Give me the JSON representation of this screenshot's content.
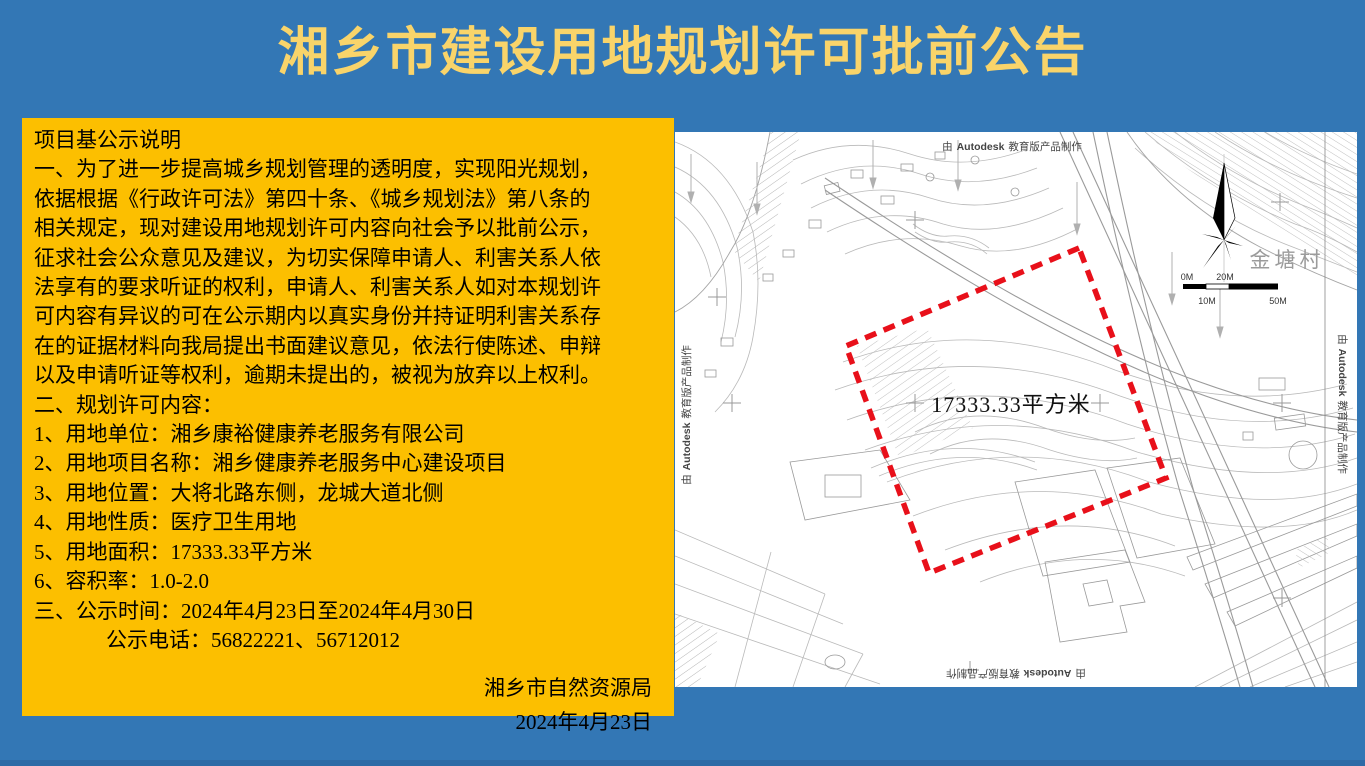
{
  "title": "湘乡市建设用地规划许可批前公告",
  "colors": {
    "background_blue": "#3377b5",
    "panel_gold": "#fcbf00",
    "title_yellow": "#f9d46a",
    "boundary_red": "#e8101a"
  },
  "notice": {
    "lines": [
      "项目基公示说明",
      "一、为了进一步提高城乡规划管理的透明度，实现阳光规划，",
      "依据根据《行政许可法》第四十条、《城乡规划法》第八条的",
      "相关规定，现对建设用地规划许可内容向社会予以批前公示，",
      "征求社会公众意见及建议，为切实保障申请人、利害关系人依",
      "法享有的要求听证的权利，申请人、利害关系人如对本规划许",
      "可内容有异议的可在公示期内以真实身份并持证明利害关系存",
      "在的证据材料向我局提出书面建议意见，依法行使陈述、申辩",
      "以及申请听证等权利，逾期未提出的，被视为放弃以上权利。",
      "二、规划许可内容：",
      "1、用地单位：湘乡康裕健康养老服务有限公司",
      "2、用地项目名称：湘乡健康养老服务中心建设项目",
      "3、用地位置：大将北路东侧，龙城大道北侧",
      "4、用地性质：医疗卫生用地",
      "5、用地面积：17333.33平方米",
      "6、容积率：1.0-2.0",
      "三、公示时间：2024年4月23日至2024年4月30日",
      "公示电话：56822221、56712012"
    ],
    "issuer": "湘乡市自然资源局",
    "date": "2024年4月23日"
  },
  "map": {
    "area_label": "17333.33平方米",
    "village_label": "金塘村",
    "watermark": {
      "prefix": "由",
      "brand": "Autodesk",
      "suffix": "教育版产品制作"
    },
    "scale": {
      "zero": "0M",
      "ten": "10M",
      "twenty": "20M",
      "fifty": "50M"
    }
  }
}
